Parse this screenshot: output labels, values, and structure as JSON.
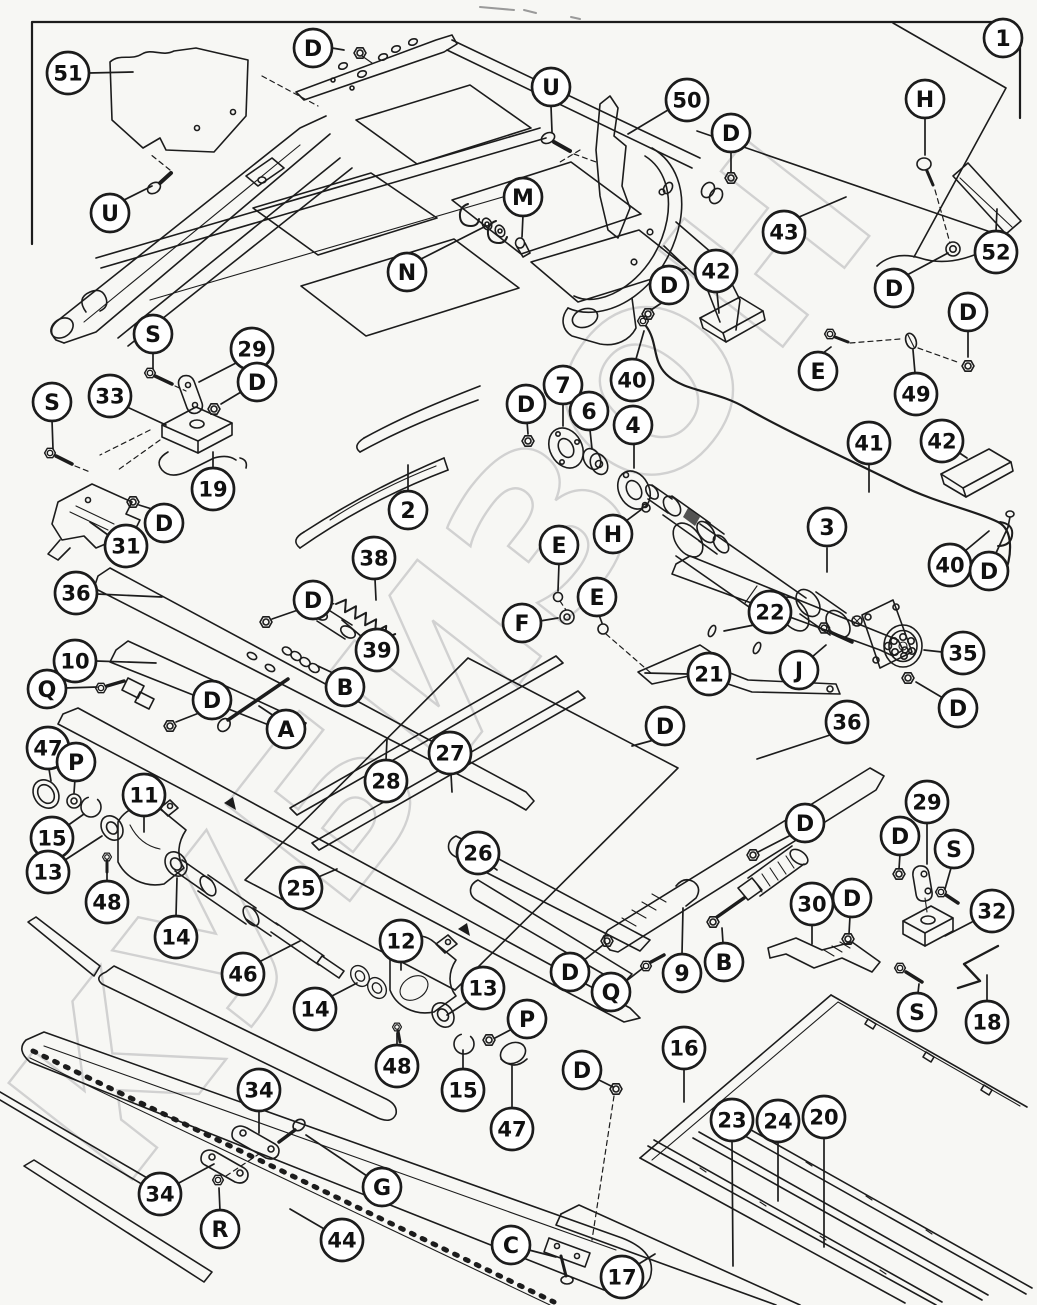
{
  "diagram": {
    "kind": "exploded-parts-diagram",
    "sheet_ref_label": "1"
  },
  "watermark": {
    "text": "КУБИЗОН",
    "color": "#cbcbcb"
  },
  "style": {
    "ink": "#1c1c1c",
    "background": "#f7f7f4",
    "callout_fill": "#ffffff"
  },
  "callouts": [
    {
      "label": "1",
      "x": 1003,
      "y": 38,
      "lead": []
    },
    {
      "label": "D",
      "x": 313,
      "y": 48,
      "lead": [
        [
          332,
          48,
          344,
          50
        ]
      ]
    },
    {
      "label": "51",
      "x": 68,
      "y": 73,
      "lead": [
        [
          89,
          73,
          133,
          72
        ]
      ]
    },
    {
      "label": "U",
      "x": 551,
      "y": 87,
      "lead": [
        [
          551,
          106,
          552,
          132
        ]
      ]
    },
    {
      "label": "50",
      "x": 687,
      "y": 100,
      "lead": [
        [
          668,
          110,
          628,
          134
        ]
      ]
    },
    {
      "label": "H",
      "x": 925,
      "y": 99,
      "lead": [
        [
          925,
          118,
          925,
          155
        ]
      ]
    },
    {
      "label": "D",
      "x": 731,
      "y": 133,
      "lead": [
        [
          731,
          151,
          731,
          172
        ]
      ]
    },
    {
      "label": "U",
      "x": 110,
      "y": 213,
      "lead": [
        [
          124,
          200,
          152,
          186
        ]
      ]
    },
    {
      "label": "M",
      "x": 523,
      "y": 197,
      "lead": [
        [
          523,
          215,
          522,
          237
        ]
      ]
    },
    {
      "label": "N",
      "x": 407,
      "y": 272,
      "lead": [
        [
          421,
          259,
          486,
          226
        ]
      ]
    },
    {
      "label": "43",
      "x": 784,
      "y": 232,
      "lead": [
        [
          799,
          217,
          846,
          197
        ]
      ]
    },
    {
      "label": "52",
      "x": 996,
      "y": 252,
      "lead": [
        [
          996,
          231,
          997,
          209
        ]
      ]
    },
    {
      "label": "D",
      "x": 894,
      "y": 288,
      "lead": [
        [
          907,
          275,
          948,
          253
        ]
      ]
    },
    {
      "label": "42",
      "x": 716,
      "y": 271,
      "lead": [
        [
          717,
          292,
          719,
          313
        ]
      ]
    },
    {
      "label": "D",
      "x": 669,
      "y": 285,
      "lead": [
        [
          663,
          302,
          651,
          310
        ]
      ]
    },
    {
      "label": "S",
      "x": 153,
      "y": 334,
      "lead": [
        [
          153,
          352,
          153,
          369
        ]
      ]
    },
    {
      "label": "29",
      "x": 252,
      "y": 349,
      "lead": [
        [
          236,
          363,
          199,
          382
        ]
      ]
    },
    {
      "label": "D",
      "x": 257,
      "y": 382,
      "lead": [
        [
          241,
          392,
          221,
          404
        ]
      ]
    },
    {
      "label": "33",
      "x": 110,
      "y": 396,
      "lead": [
        [
          127,
          407,
          166,
          425
        ]
      ]
    },
    {
      "label": "S",
      "x": 52,
      "y": 402,
      "lead": [
        [
          52,
          420,
          53,
          449
        ]
      ]
    },
    {
      "label": "40",
      "x": 632,
      "y": 380,
      "lead": [
        [
          636,
          359,
          644,
          331
        ]
      ]
    },
    {
      "label": "E",
      "x": 818,
      "y": 371,
      "lead": [
        [
          823,
          353,
          831,
          347
        ]
      ]
    },
    {
      "label": "49",
      "x": 916,
      "y": 394,
      "lead": [
        [
          915,
          373,
          913,
          350
        ]
      ]
    },
    {
      "label": "D",
      "x": 968,
      "y": 312,
      "lead": [
        [
          968,
          330,
          968,
          357
        ]
      ]
    },
    {
      "label": "7",
      "x": 563,
      "y": 385,
      "lead": [
        [
          563,
          404,
          563,
          426
        ]
      ]
    },
    {
      "label": "6",
      "x": 589,
      "y": 411,
      "lead": [
        [
          590,
          430,
          592,
          449
        ]
      ]
    },
    {
      "label": "D",
      "x": 526,
      "y": 404,
      "lead": [
        [
          527,
          421,
          528,
          434
        ]
      ]
    },
    {
      "label": "4",
      "x": 633,
      "y": 425,
      "lead": [
        [
          634,
          444,
          634,
          468
        ]
      ]
    },
    {
      "label": "2",
      "x": 408,
      "y": 510,
      "lead": [
        [
          408,
          491,
          408,
          465
        ]
      ]
    },
    {
      "label": "19",
      "x": 213,
      "y": 489,
      "lead": [
        [
          213,
          468,
          213,
          452
        ]
      ]
    },
    {
      "label": "D",
      "x": 164,
      "y": 523,
      "lead": [
        [
          152,
          509,
          139,
          505
        ]
      ]
    },
    {
      "label": "31",
      "x": 126,
      "y": 546,
      "lead": [
        [
          108,
          535,
          90,
          522
        ]
      ]
    },
    {
      "label": "3",
      "x": 827,
      "y": 527,
      "lead": [
        [
          827,
          548,
          827,
          572
        ]
      ]
    },
    {
      "label": "41",
      "x": 869,
      "y": 443,
      "lead": [
        [
          869,
          464,
          869,
          492
        ]
      ]
    },
    {
      "label": "42",
      "x": 942,
      "y": 441,
      "lead": [
        [
          958,
          452,
          967,
          458
        ]
      ]
    },
    {
      "label": "40",
      "x": 950,
      "y": 565,
      "lead": [
        [
          965,
          551,
          989,
          531
        ]
      ]
    },
    {
      "label": "D",
      "x": 989,
      "y": 571,
      "lead": [
        [
          996,
          553,
          1009,
          525
        ]
      ]
    },
    {
      "label": "H",
      "x": 613,
      "y": 534,
      "lead": [
        [
          626,
          521,
          642,
          509
        ]
      ]
    },
    {
      "label": "E",
      "x": 559,
      "y": 545,
      "lead": [
        [
          559,
          563,
          558,
          591
        ]
      ]
    },
    {
      "label": "E",
      "x": 597,
      "y": 597,
      "lead": [
        [
          599,
          615,
          602,
          623
        ]
      ]
    },
    {
      "label": "F",
      "x": 522,
      "y": 623,
      "lead": [
        [
          540,
          621,
          558,
          618
        ]
      ]
    },
    {
      "label": "22",
      "x": 770,
      "y": 612,
      "lead": [
        [
          754,
          625,
          724,
          631
        ]
      ]
    },
    {
      "label": "21",
      "x": 709,
      "y": 674,
      "lead": [
        [
          688,
          674,
          645,
          673
        ]
      ]
    },
    {
      "label": "J",
      "x": 799,
      "y": 670,
      "lead": [
        [
          812,
          657,
          826,
          645
        ]
      ]
    },
    {
      "label": "35",
      "x": 963,
      "y": 653,
      "lead": [
        [
          942,
          652,
          924,
          650
        ]
      ]
    },
    {
      "label": "D",
      "x": 958,
      "y": 708,
      "lead": [
        [
          943,
          698,
          916,
          682
        ]
      ]
    },
    {
      "label": "36",
      "x": 847,
      "y": 722,
      "lead": [
        [
          830,
          735,
          757,
          759
        ]
      ]
    },
    {
      "label": "D",
      "x": 665,
      "y": 726,
      "lead": [
        [
          654,
          740,
          632,
          746
        ]
      ]
    },
    {
      "label": "38",
      "x": 374,
      "y": 558,
      "lead": [
        [
          375,
          579,
          376,
          600
        ]
      ]
    },
    {
      "label": "D",
      "x": 313,
      "y": 600,
      "lead": [
        [
          298,
          610,
          272,
          619
        ]
      ]
    },
    {
      "label": "36",
      "x": 76,
      "y": 593,
      "lead": [
        [
          97,
          594,
          162,
          597
        ]
      ]
    },
    {
      "label": "39",
      "x": 377,
      "y": 650,
      "lead": [
        [
          362,
          637,
          342,
          620
        ]
      ]
    },
    {
      "label": "10",
      "x": 75,
      "y": 661,
      "lead": [
        [
          96,
          661,
          156,
          663
        ]
      ]
    },
    {
      "label": "Q",
      "x": 47,
      "y": 689,
      "lead": [
        [
          65,
          688,
          97,
          687
        ]
      ]
    },
    {
      "label": "D",
      "x": 212,
      "y": 700,
      "lead": [
        [
          199,
          713,
          176,
          722
        ]
      ]
    },
    {
      "label": "B",
      "x": 345,
      "y": 687,
      "lead": [
        [
          333,
          673,
          318,
          666
        ]
      ]
    },
    {
      "label": "A",
      "x": 286,
      "y": 729,
      "lead": [
        [
          274,
          716,
          259,
          706
        ]
      ]
    },
    {
      "label": "47",
      "x": 48,
      "y": 748,
      "lead": [
        [
          49,
          769,
          51,
          781
        ]
      ]
    },
    {
      "label": "P",
      "x": 76,
      "y": 762,
      "lead": [
        [
          75,
          779,
          74,
          793
        ]
      ]
    },
    {
      "label": "15",
      "x": 52,
      "y": 838,
      "lead": [
        [
          67,
          826,
          84,
          814
        ]
      ]
    },
    {
      "label": "13",
      "x": 48,
      "y": 872,
      "lead": [
        [
          65,
          860,
          102,
          836
        ]
      ]
    },
    {
      "label": "48",
      "x": 107,
      "y": 902,
      "lead": [
        [
          107,
          881,
          107,
          867
        ]
      ]
    },
    {
      "label": "11",
      "x": 144,
      "y": 795,
      "lead": [
        [
          144,
          814,
          144,
          832
        ]
      ]
    },
    {
      "label": "14",
      "x": 176,
      "y": 937,
      "lead": [
        [
          176,
          916,
          177,
          878
        ]
      ]
    },
    {
      "label": "46",
      "x": 243,
      "y": 974,
      "lead": [
        [
          259,
          962,
          300,
          941
        ]
      ]
    },
    {
      "label": "25",
      "x": 301,
      "y": 888,
      "lead": [
        [
          316,
          878,
          337,
          869
        ]
      ]
    },
    {
      "label": "28",
      "x": 386,
      "y": 781,
      "lead": [
        [
          386,
          760,
          387,
          739
        ]
      ]
    },
    {
      "label": "27",
      "x": 450,
      "y": 753,
      "lead": [
        [
          451,
          774,
          452,
          792
        ]
      ]
    },
    {
      "label": "26",
      "x": 478,
      "y": 853,
      "lead": [
        [
          489,
          864,
          497,
          870
        ]
      ]
    },
    {
      "label": "12",
      "x": 401,
      "y": 941,
      "lead": [
        [
          401,
          960,
          401,
          970
        ]
      ]
    },
    {
      "label": "13",
      "x": 483,
      "y": 988,
      "lead": [
        [
          470,
          1000,
          447,
          1015
        ]
      ]
    },
    {
      "label": "P",
      "x": 527,
      "y": 1019,
      "lead": [
        [
          514,
          1028,
          495,
          1038
        ]
      ]
    },
    {
      "label": "48",
      "x": 397,
      "y": 1066,
      "lead": [
        [
          397,
          1045,
          397,
          1033
        ]
      ]
    },
    {
      "label": "15",
      "x": 463,
      "y": 1090,
      "lead": [
        [
          463,
          1069,
          463,
          1050
        ]
      ]
    },
    {
      "label": "47",
      "x": 512,
      "y": 1129,
      "lead": [
        [
          512,
          1108,
          512,
          1066
        ]
      ]
    },
    {
      "label": "14",
      "x": 315,
      "y": 1009,
      "lead": [
        [
          330,
          997,
          357,
          983
        ]
      ]
    },
    {
      "label": "D",
      "x": 570,
      "y": 972,
      "lead": [
        [
          583,
          961,
          603,
          945
        ]
      ]
    },
    {
      "label": "Q",
      "x": 611,
      "y": 992,
      "lead": [
        [
          625,
          982,
          643,
          968
        ]
      ]
    },
    {
      "label": "9",
      "x": 682,
      "y": 973,
      "lead": [
        [
          682,
          954,
          683,
          908
        ]
      ]
    },
    {
      "label": "B",
      "x": 724,
      "y": 962,
      "lead": [
        [
          723,
          943,
          722,
          928
        ]
      ]
    },
    {
      "label": "D",
      "x": 805,
      "y": 823,
      "lead": [
        [
          791,
          835,
          758,
          852
        ]
      ]
    },
    {
      "label": "29",
      "x": 927,
      "y": 802,
      "lead": [
        [
          927,
          823,
          927,
          864
        ]
      ]
    },
    {
      "label": "D",
      "x": 900,
      "y": 836,
      "lead": [
        [
          900,
          854,
          899,
          869
        ]
      ]
    },
    {
      "label": "S",
      "x": 954,
      "y": 849,
      "lead": [
        [
          951,
          868,
          945,
          889
        ]
      ]
    },
    {
      "label": "30",
      "x": 812,
      "y": 904,
      "lead": [
        [
          812,
          925,
          812,
          944
        ]
      ]
    },
    {
      "label": "D",
      "x": 852,
      "y": 898,
      "lead": [
        [
          850,
          916,
          849,
          934
        ]
      ]
    },
    {
      "label": "32",
      "x": 992,
      "y": 911,
      "lead": [
        [
          972,
          922,
          945,
          936
        ]
      ]
    },
    {
      "label": "S",
      "x": 917,
      "y": 1012,
      "lead": [
        [
          918,
          993,
          919,
          984
        ]
      ]
    },
    {
      "label": "18",
      "x": 987,
      "y": 1022,
      "lead": [
        [
          987,
          1001,
          987,
          975
        ]
      ]
    },
    {
      "label": "16",
      "x": 684,
      "y": 1048,
      "lead": [
        [
          684,
          1069,
          684,
          1102
        ]
      ]
    },
    {
      "label": "D",
      "x": 582,
      "y": 1070,
      "lead": [
        [
          595,
          1078,
          613,
          1087
        ]
      ]
    },
    {
      "label": "23",
      "x": 732,
      "y": 1120,
      "lead": [
        [
          732,
          1141,
          733,
          1266
        ]
      ]
    },
    {
      "label": "24",
      "x": 778,
      "y": 1121,
      "lead": [
        [
          778,
          1142,
          778,
          1201
        ]
      ]
    },
    {
      "label": "20",
      "x": 824,
      "y": 1117,
      "lead": [
        [
          824,
          1138,
          824,
          1247
        ]
      ]
    },
    {
      "label": "17",
      "x": 622,
      "y": 1277,
      "lead": [
        [
          637,
          1265,
          655,
          1254
        ]
      ]
    },
    {
      "label": "C",
      "x": 511,
      "y": 1245,
      "lead": [
        [
          529,
          1250,
          556,
          1257
        ]
      ]
    },
    {
      "label": "34",
      "x": 259,
      "y": 1090,
      "lead": [
        [
          259,
          1111,
          259,
          1133
        ]
      ]
    },
    {
      "label": "34",
      "x": 160,
      "y": 1194,
      "lead": [
        [
          177,
          1184,
          214,
          1164
        ]
      ]
    },
    {
      "label": "R",
      "x": 220,
      "y": 1229,
      "lead": [
        [
          220,
          1211,
          219,
          1188
        ]
      ]
    },
    {
      "label": "G",
      "x": 382,
      "y": 1187,
      "lead": [
        [
          367,
          1176,
          306,
          1135
        ]
      ]
    },
    {
      "label": "44",
      "x": 342,
      "y": 1240,
      "lead": [
        [
          326,
          1230,
          290,
          1209
        ]
      ]
    }
  ]
}
